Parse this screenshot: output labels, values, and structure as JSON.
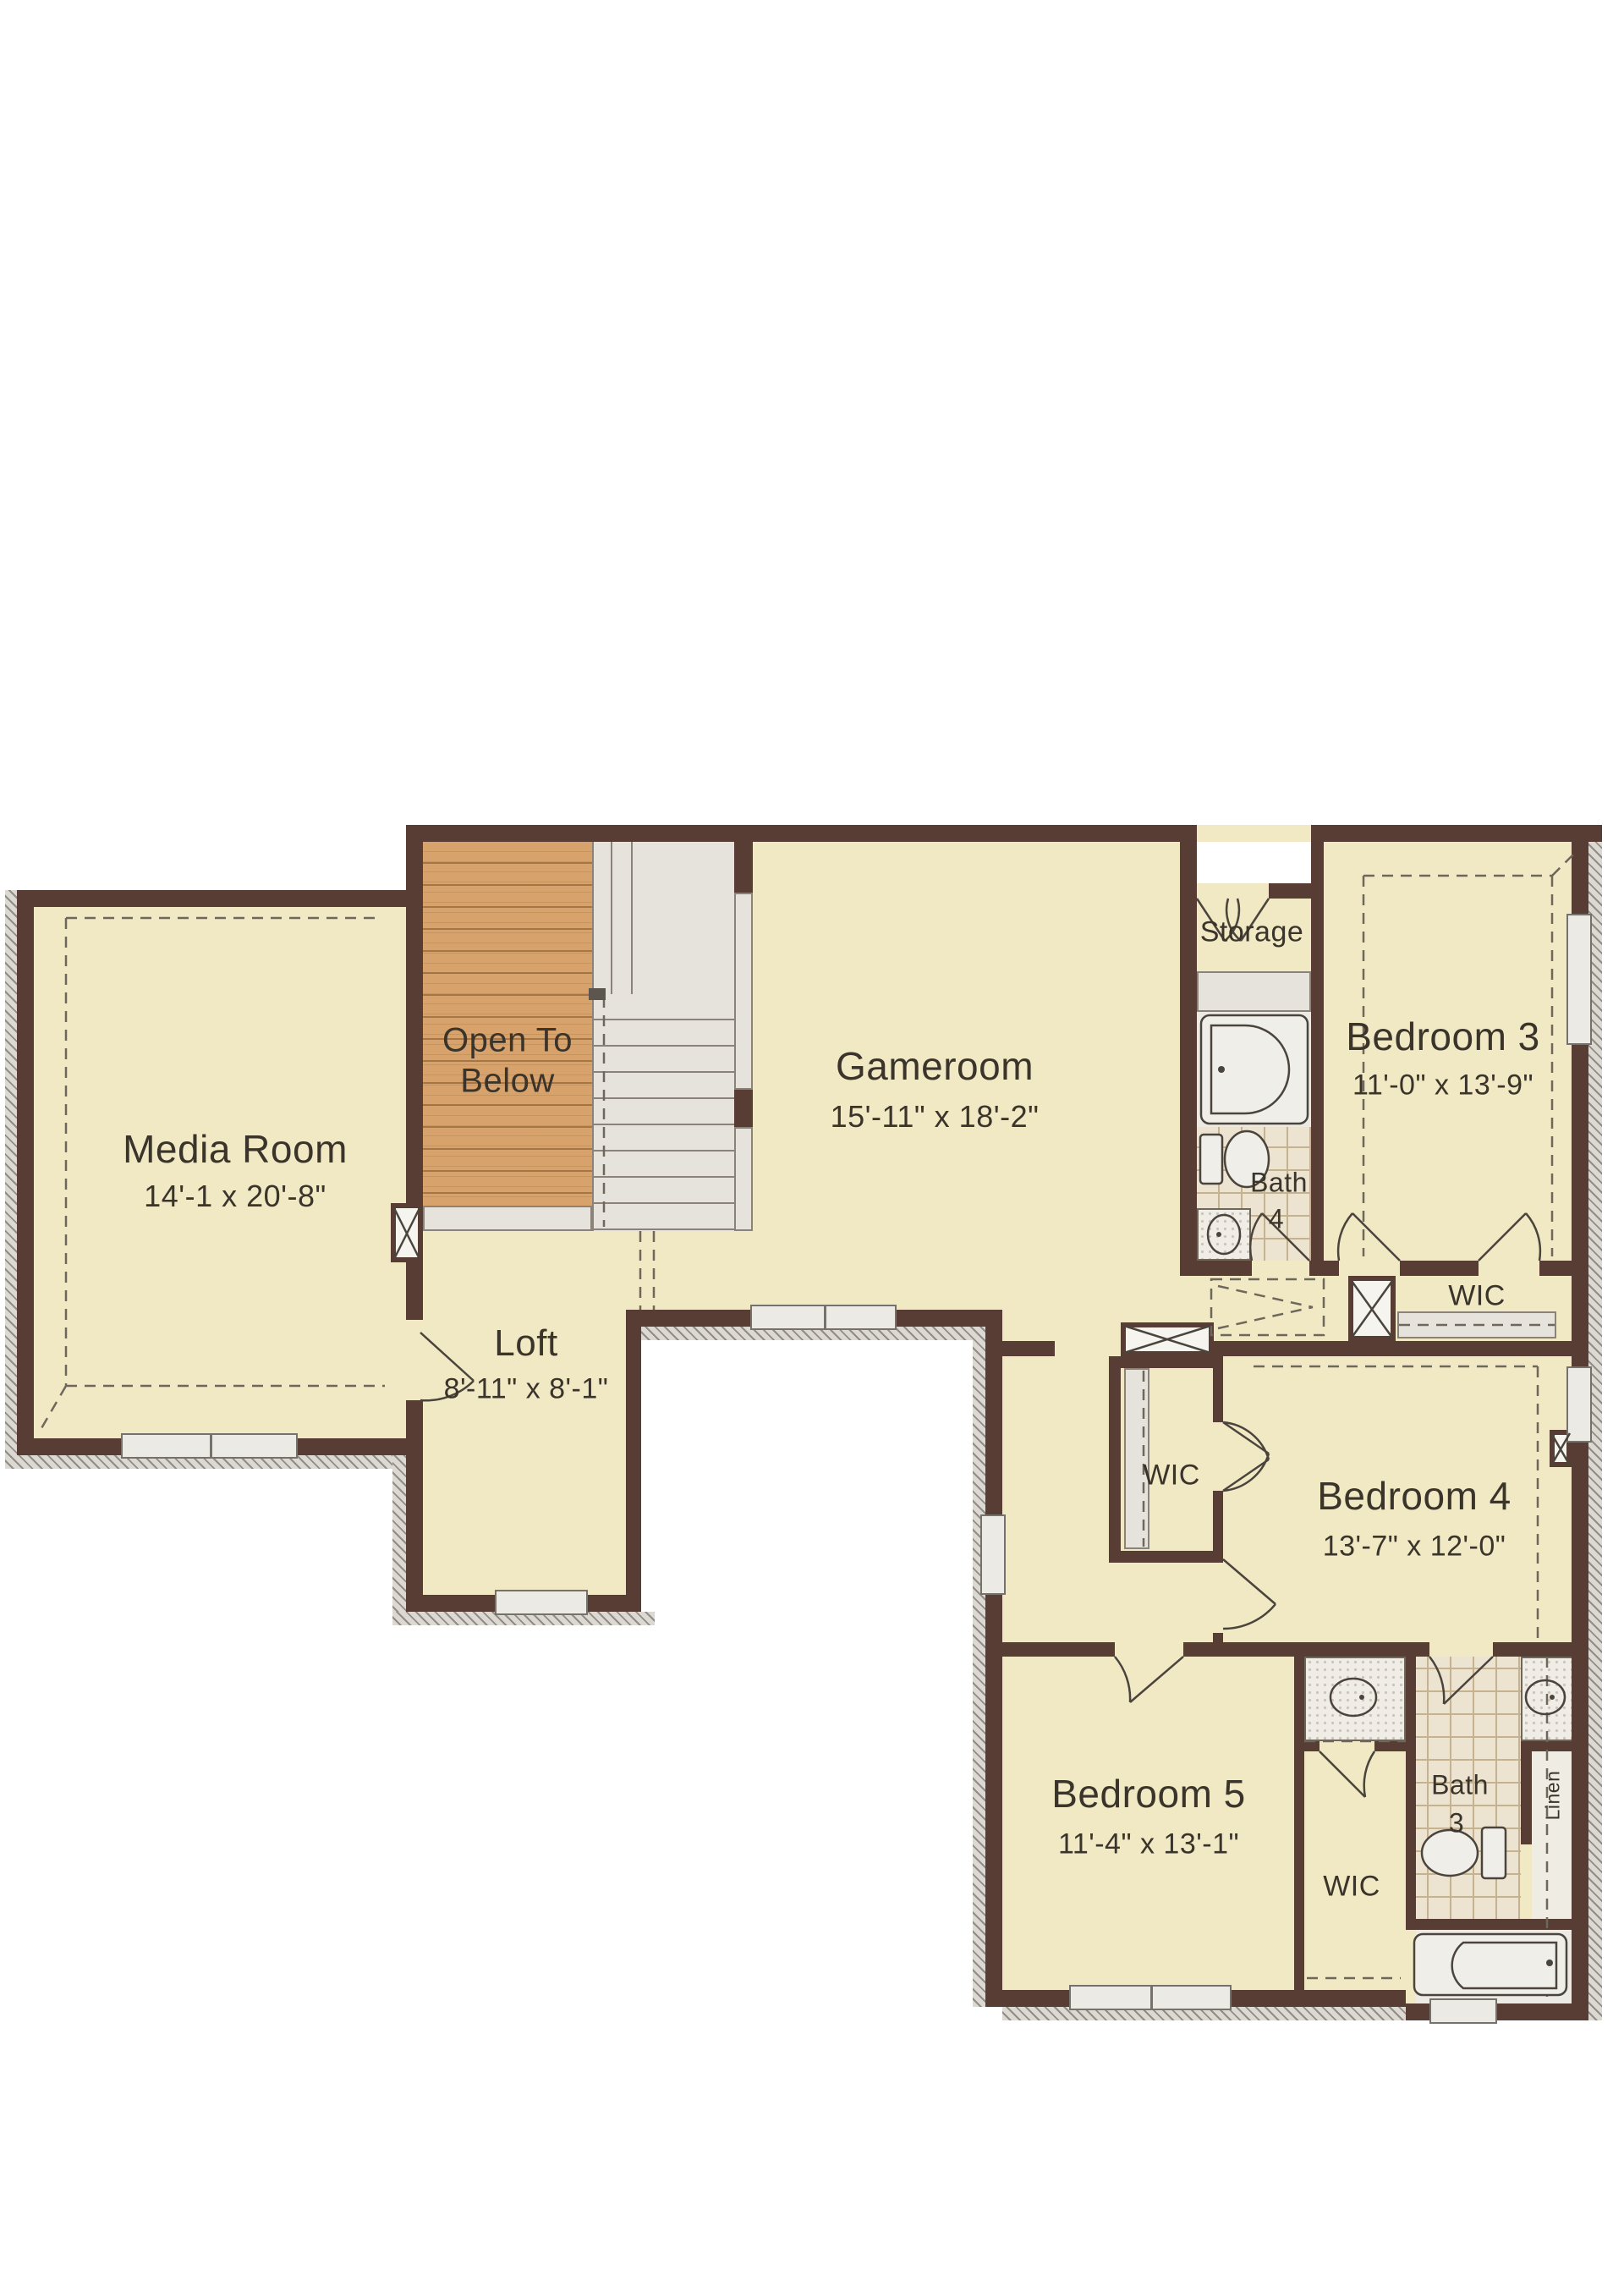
{
  "rooms": {
    "media_room": {
      "name": "Media Room",
      "dims": "14'-1 x 20'-8\""
    },
    "open_to_below": {
      "line1": "Open To",
      "line2": "Below"
    },
    "loft": {
      "name": "Loft",
      "dims": "8'-11\" x 8'-1\""
    },
    "gameroom": {
      "name": "Gameroom",
      "dims": "15'-11\" x 18'-2\""
    },
    "storage": {
      "name": "Storage"
    },
    "bath_4": {
      "name": "Bath",
      "number": "4"
    },
    "bedroom_3": {
      "name": "Bedroom 3",
      "dims": "11'-0\" x 13'-9\""
    },
    "wic_bedroom_3": {
      "name": "WIC"
    },
    "bedroom_4": {
      "name": "Bedroom 4",
      "dims": "13'-7\" x 12'-0\""
    },
    "wic_bedroom_4": {
      "name": "WIC"
    },
    "bedroom_5": {
      "name": "Bedroom 5",
      "dims": "11'-4\" x 13'-1\""
    },
    "wic_bedroom_5": {
      "name": "WIC"
    },
    "bath_3": {
      "name": "Bath",
      "number": "3"
    },
    "linen": {
      "name": "Linen"
    }
  },
  "colors": {
    "floor_cream": "#f0e9c4",
    "wall_brown": "#573d34",
    "wood_tan": "#d7a26b",
    "stair_gray": "#e6e3dc",
    "tile_beige": "#ece4d1",
    "outside_white": "#ffffff"
  },
  "fixtures": [
    "tub-icon",
    "toilet-icon",
    "sink-icon",
    "stair-treads",
    "attic-access-hatch",
    "chase-x",
    "door-swing-arc",
    "window"
  ]
}
